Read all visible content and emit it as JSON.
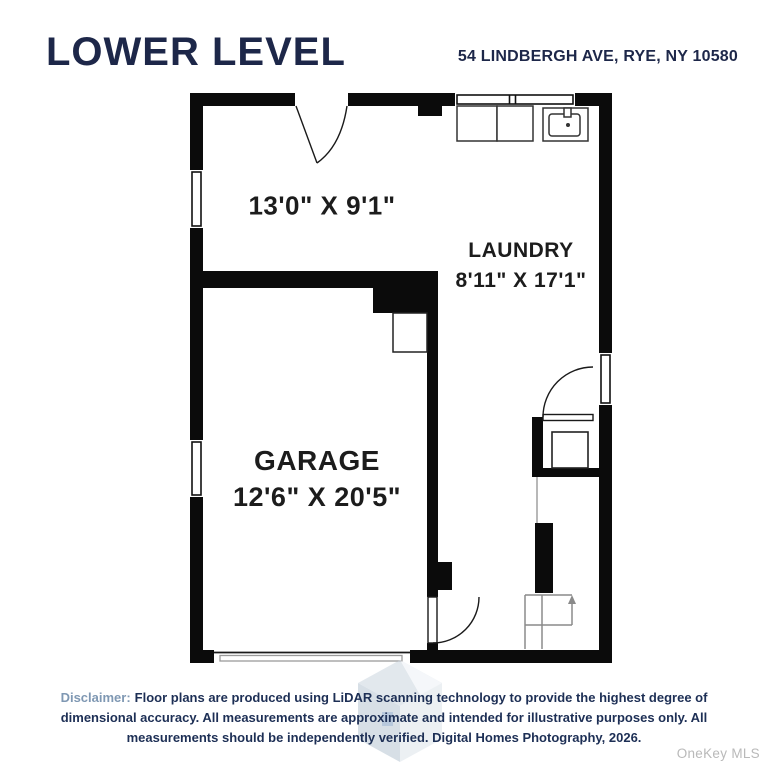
{
  "header": {
    "title": "LOWER LEVEL",
    "address": "54 LINDBERGH AVE, RYE, NY 10580"
  },
  "floorplan": {
    "rooms": [
      {
        "name": "",
        "dimensions": "13'0\" X 9'1\""
      },
      {
        "name": "LAUNDRY",
        "dimensions": "8'11\" X 17'1\""
      },
      {
        "name": "GARAGE",
        "dimensions": "12'6\" X 20'5\""
      }
    ],
    "features": [
      "front-room-door",
      "laundry-window",
      "washer",
      "dryer",
      "sink",
      "utility-closet-door",
      "water-heater",
      "stairs-up-arrow",
      "garage-hall-door",
      "garage-overhead-door",
      "windows"
    ]
  },
  "footer": {
    "disclaimer_label": "Disclaimer:",
    "disclaimer_text": "Floor plans are produced using LiDAR scanning technology to provide the highest degree of dimensional accuracy. All measurements are approximate and intended for illustrative purposes only. All measurements should be independently verified. Digital Homes Photography, 2026.",
    "mls_watermark": "OneKey MLS"
  },
  "colors": {
    "navy": "#1d2749",
    "disclaimer_label_blue": "#7f98b3",
    "wall_black": "#0b0b0b",
    "room_text": "#1c1c1c",
    "mls_gray": "#b9b9b9",
    "watermark_blue": "#c3cfdb"
  }
}
